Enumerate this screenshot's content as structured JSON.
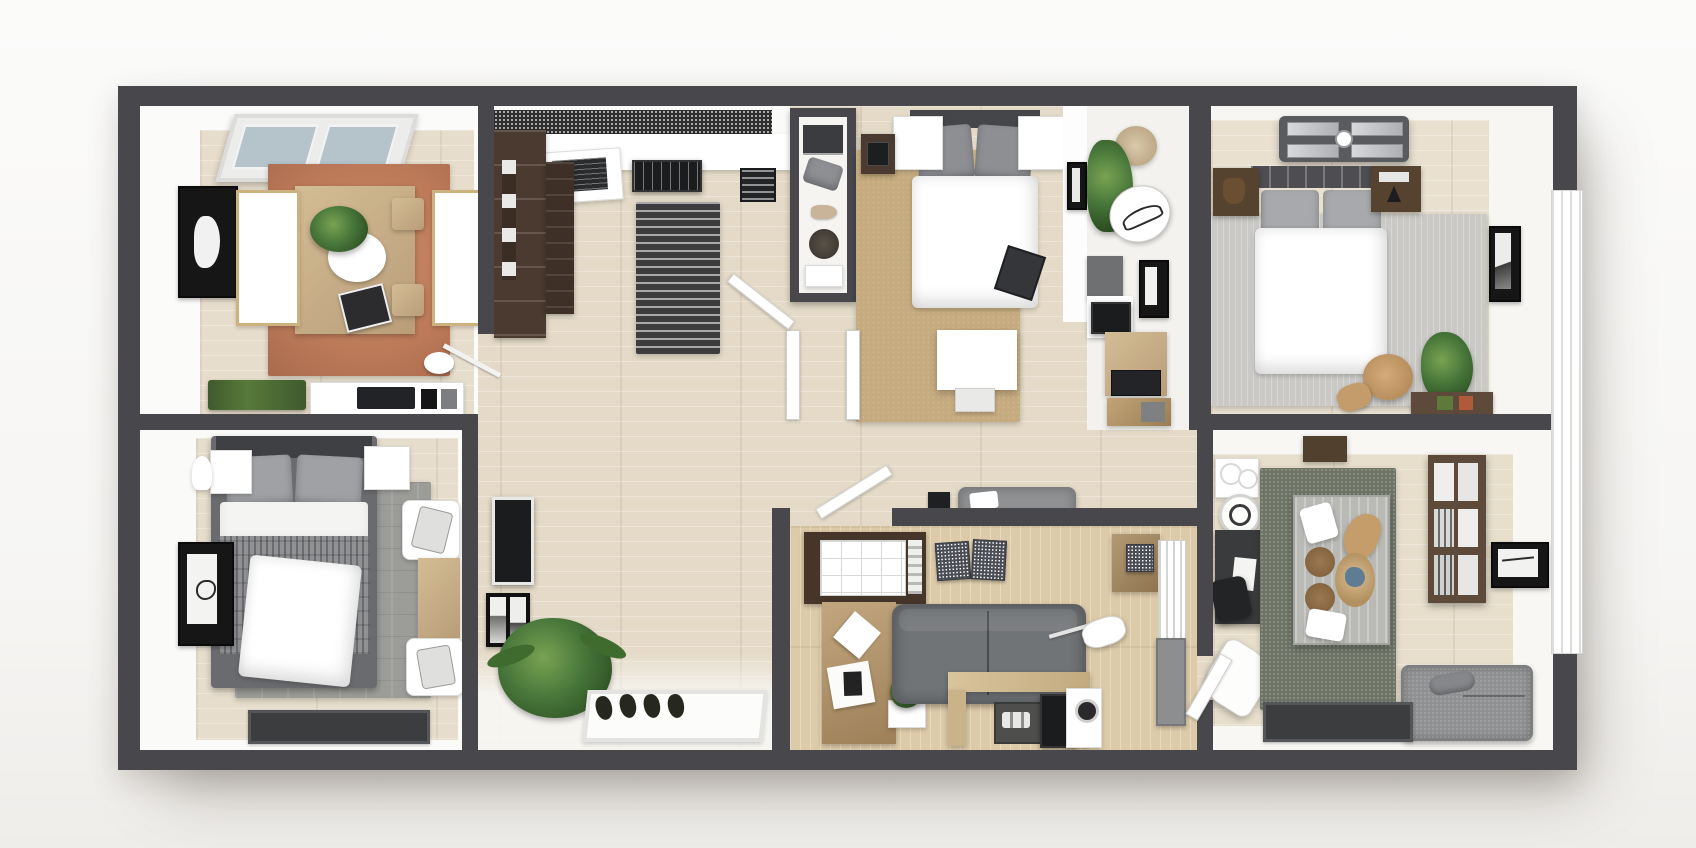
{
  "scene": {
    "title": "3D rendered apartment floor plan, top-down view",
    "style": "photoreal architectural render, no visible text",
    "palette": {
      "bg_top": "#fbfbfa",
      "bg_bottom": "#efedea",
      "wall": "#48484c",
      "floor_main": "#e4dac7",
      "floor_dining": "#e7ddcc",
      "floor_living": "#dccaa8",
      "floor_kids": "#e7decb",
      "floor_master": "#e9e0d0",
      "rug_dining": "#bc7a59",
      "rug_bed2": "#c5ab7e",
      "rug_master": "#cac9c5",
      "rug_bed1": "#9c9c99",
      "rug_kids": "#6e7466",
      "runner": "#3d3d3d",
      "cab_brown": "#4a3a2f",
      "wood_mid": "#b99d79",
      "wood_light": "#d3bd95",
      "shelf_dark": "#5d4a3a",
      "sofa": "#717477",
      "bench": "#8f9192",
      "daybed": "#b9bab6",
      "mat": "#3c3d3f",
      "plant1": "#47763a",
      "plant2": "#2d4f22",
      "tv_black": "#1b1c1e",
      "glass": "#b5c3cb"
    },
    "rooms": [
      {
        "id": "dining-room",
        "name": "Dining room",
        "features": [
          "skylight window",
          "terracotta rug",
          "wood dining table",
          "two white benches",
          "two wood chairs",
          "wall art",
          "floor lamp",
          "planter row",
          "appliance sideboard"
        ]
      },
      {
        "id": "kitchen",
        "name": "Kitchen",
        "features": [
          "mosaic backsplash",
          "white counter",
          "cooktop",
          "vent hood unit",
          "tall brown cabinets",
          "striped runner rug",
          "counter stool"
        ]
      },
      {
        "id": "walk-in-closet",
        "name": "Closet nook",
        "features": [
          "open shelves",
          "storage boxes",
          "pillow",
          "round basket"
        ]
      },
      {
        "id": "bedroom-2",
        "name": "Bedroom 2",
        "features": [
          "double bed",
          "tan rug",
          "floating nightstands",
          "white desk and stool",
          "hall bench"
        ]
      },
      {
        "id": "study-nook",
        "name": "Study nook",
        "features": [
          "potted plant",
          "hanging chair",
          "sketch decor",
          "art frame",
          "tv console",
          "desk with microwave"
        ]
      },
      {
        "id": "master-bedroom",
        "name": "Master bedroom",
        "features": [
          "ceiling fan",
          "double bed",
          "wood nightstands",
          "light gray rug",
          "art frame",
          "plant",
          "round side chair",
          "low shelf"
        ]
      },
      {
        "id": "bedroom-1",
        "name": "Bedroom 1",
        "features": [
          "double bed with patterned blanket",
          "gray rug",
          "white nightstands",
          "wall art",
          "desk with two graphic chairs",
          "dark floor mat"
        ]
      },
      {
        "id": "hallway-entry",
        "name": "Hallway / entry",
        "features": [
          "wall tv",
          "picture frames",
          "fern plant",
          "four pairs of shoes",
          "white entry mat",
          "open doors"
        ]
      },
      {
        "id": "living-room",
        "name": "Living room",
        "features": [
          "grid-front cabinet",
          "patterned boxes",
          "pegboard desk",
          "gray sofa",
          "wood console with coffee gear",
          "arc floor lamp",
          "striped wardrobe"
        ]
      },
      {
        "id": "kids-room",
        "name": "Kids room / studio",
        "features": [
          "sage green rug",
          "gray daybed table with pillows",
          "dark desk and chair",
          "tipped white chair",
          "wall bookshelf",
          "art frame",
          "gray bench",
          "dark floor mat",
          "towel shelf",
          "round side table"
        ]
      }
    ],
    "exterior": {
      "right_side_window": "tall glazing strip on right exterior wall",
      "shadow": "soft drop shadow under slab"
    }
  }
}
